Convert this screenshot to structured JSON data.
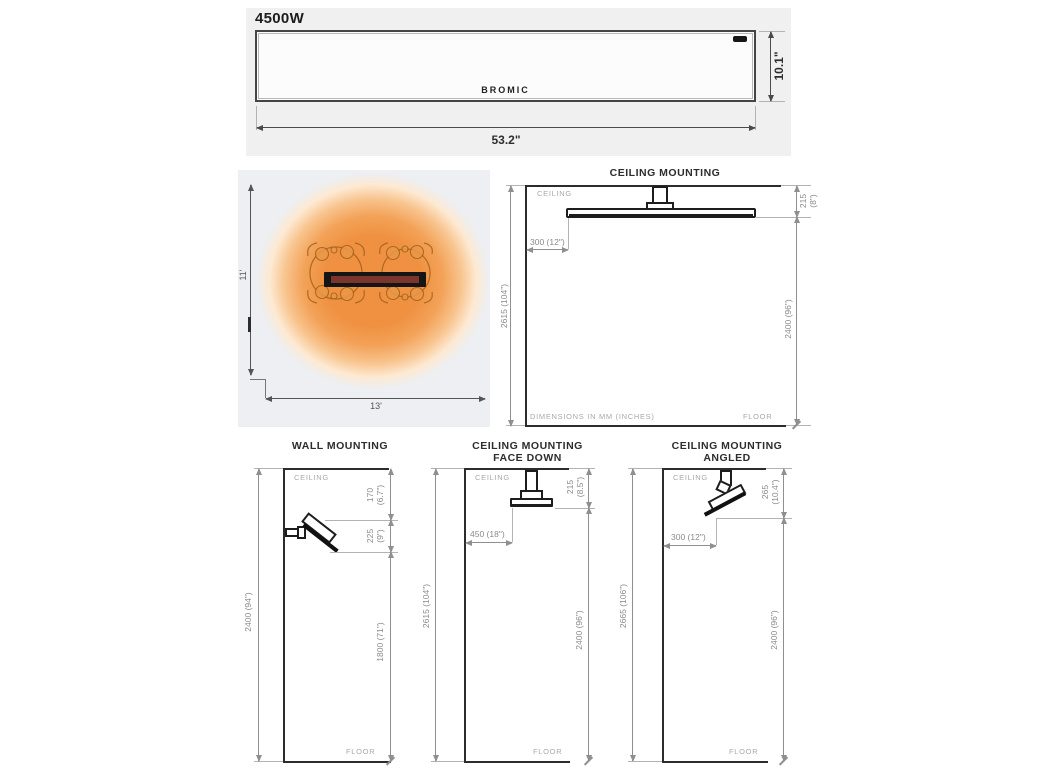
{
  "front_view": {
    "model": "4500W",
    "brand": "BROMIC",
    "width": "53.2\"",
    "height": "10.1\""
  },
  "heat_map": {
    "depth": "11'",
    "width": "13'"
  },
  "ceiling_main": {
    "title": "CEILING MOUNTING",
    "ceiling": "CEILING",
    "floor": "FLOOR",
    "note": "DIMENSIONS IN MM (INCHES)",
    "drop_mm": "215",
    "drop_in": "(8\")",
    "offset": "300 (12\")",
    "total": "2615 (104\")",
    "clearance": "2400 (96\")"
  },
  "wall_mount": {
    "title": "WALL MOUNTING",
    "ceiling": "CEILING",
    "floor": "FLOOR",
    "total": "2400 (94\")",
    "top_mm": "170",
    "top_in": "(6.7\")",
    "drop_mm": "225",
    "drop_in": "(9\")",
    "clearance": "1800 (71\")"
  },
  "face_down": {
    "title1": "CEILING MOUNTING",
    "title2": "FACE DOWN",
    "ceiling": "CEILING",
    "floor": "FLOOR",
    "drop_mm": "215",
    "drop_in": "(8.5\")",
    "offset": "450 (18\")",
    "total": "2615 (104\")",
    "clearance": "2400 (96\")"
  },
  "angled": {
    "title1": "CEILING MOUNTING",
    "title2": "ANGLED",
    "ceiling": "CEILING",
    "floor": "FLOOR",
    "drop_mm": "265",
    "drop_in": "(10.4\")",
    "offset": "300 (12\")",
    "total": "2665 (106\")",
    "clearance": "2400 (96\")"
  },
  "colors": {
    "heat_core": "#ef9141",
    "heater_face": "#7c352c",
    "line_dark": "#2c2c2c",
    "line_dim": "#8f8f8f",
    "label_gray": "#a6a9ad",
    "panel_bg": "#f0f0f0",
    "heatmap_bg": "#edeff2"
  }
}
